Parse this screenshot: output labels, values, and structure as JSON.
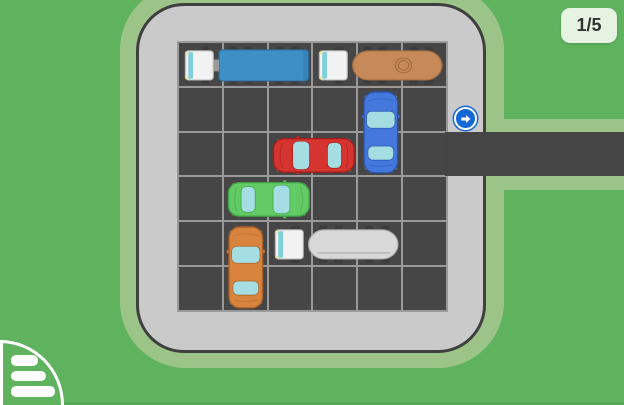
{
  "hud": {
    "level_label": "1/5"
  },
  "exit": {
    "icon": "arrow-right-icon",
    "row": 2,
    "side": "right"
  },
  "menu": {
    "icon": "menu-list-icon"
  },
  "board": {
    "rows": 6,
    "cols": 6
  },
  "vehicles": [
    {
      "id": "blue-truck",
      "type": "truck",
      "row": 0,
      "col": 0,
      "length": 3,
      "orientation": "horizontal",
      "facing": "right",
      "body": "#3e8fc6",
      "outline": "#2d6f9e"
    },
    {
      "id": "tan-tanker",
      "type": "tanker",
      "row": 0,
      "col": 3,
      "length": 3,
      "orientation": "horizontal",
      "facing": "right",
      "body": "#c68a5a",
      "outline": "#9e6a3c",
      "detail": "circle"
    },
    {
      "id": "blue-car",
      "type": "car",
      "row": 1,
      "col": 4,
      "length": 2,
      "orientation": "vertical",
      "facing": "up",
      "body": "#4478dc",
      "outline": "#2b55ae"
    },
    {
      "id": "red-car",
      "type": "car",
      "row": 2,
      "col": 2,
      "length": 2,
      "orientation": "horizontal",
      "facing": "left",
      "body": "#d63430",
      "outline": "#a31d1d"
    },
    {
      "id": "green-car",
      "type": "car",
      "row": 3,
      "col": 1,
      "length": 2,
      "orientation": "horizontal",
      "facing": "right",
      "body": "#63cb66",
      "outline": "#3fa144"
    },
    {
      "id": "orange-car",
      "type": "car",
      "row": 4,
      "col": 1,
      "length": 2,
      "orientation": "vertical",
      "facing": "up",
      "body": "#d8843e",
      "outline": "#aa6128"
    },
    {
      "id": "white-tanker",
      "type": "tanker",
      "row": 4,
      "col": 2,
      "length": 3,
      "orientation": "horizontal",
      "facing": "right",
      "body": "#d8d8d8",
      "outline": "#a9a9a9",
      "detail": "line"
    }
  ],
  "colors": {
    "background": "#5fb35f",
    "halo": "#9cc489",
    "board": "#cacaca",
    "board_outline": "#3f3f3f",
    "cell": "#464646",
    "grid_line": "#9a9a9a",
    "road": "#454545",
    "badge_bg": "#e6f2e2",
    "badge_text": "#323232",
    "arrow_blue": "#1468d6",
    "ground_strip": "#54a658",
    "window": "#a5dee2",
    "cab": "#f2f2f2",
    "cab_window": "#7fd0da",
    "headlight": "#f3e88f",
    "wheel": "#3c3c3c"
  }
}
